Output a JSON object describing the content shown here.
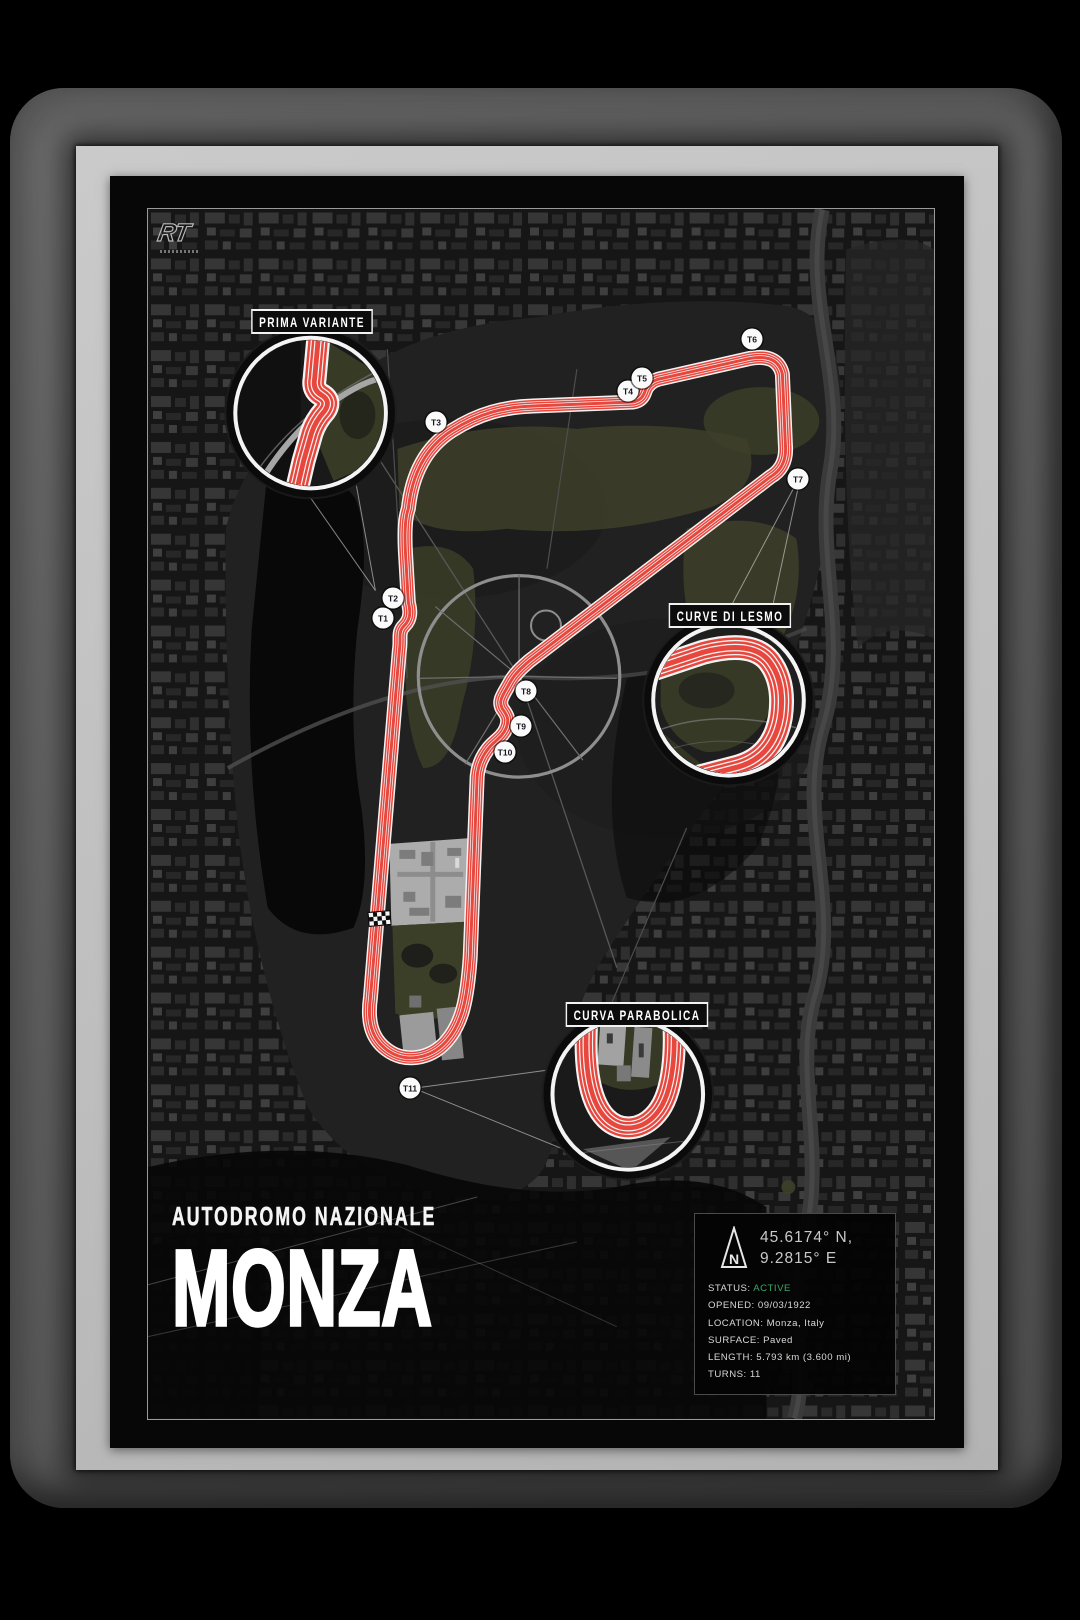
{
  "brand": {
    "logo_text": "RT"
  },
  "poster": {
    "subtitle": "AUTODROMO NAZIONALE",
    "title": "MONZA"
  },
  "map": {
    "turn_labels": [
      "T1",
      "T2",
      "T3",
      "T4",
      "T5",
      "T6",
      "T7",
      "T8",
      "T9",
      "T10",
      "T11"
    ],
    "callouts": [
      {
        "label": "PRIMA VARIANTE"
      },
      {
        "label": "CURVE DI LESMO"
      },
      {
        "label": "CURVA PARABOLICA"
      }
    ],
    "start_finish_marker": "checkered-flag"
  },
  "info_panel": {
    "compass_letter": "N",
    "coordinates": [
      "45.6174° N,",
      "9.2815° E"
    ],
    "rows": [
      {
        "label": "STATUS:",
        "value": "ACTIVE"
      },
      {
        "label": "OPENED:",
        "value": "09/03/1922"
      },
      {
        "label": "LOCATION:",
        "value": "Monza, Italy"
      },
      {
        "label": "SURFACE:",
        "value": "Paved"
      },
      {
        "label": "LENGTH:",
        "value": "5.793 km (3.600 mi)"
      },
      {
        "label": "TURNS:",
        "value": "11"
      }
    ]
  },
  "colors": {
    "track_red": "#e8473e",
    "track_stripe_white": "#f4f4f4",
    "status_active_green": "#3aa768",
    "mat_silver": "#c4c4c4",
    "frame_gray": "#6f6f6f",
    "poster_black": "#070707",
    "vegetation_olive": "#3d4029"
  }
}
